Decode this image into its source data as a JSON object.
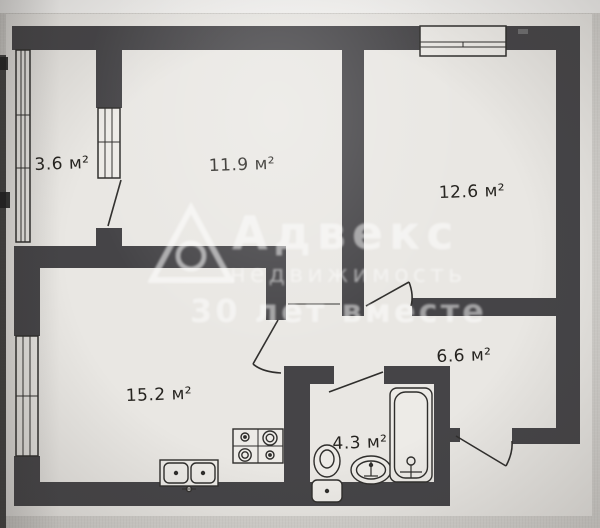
{
  "plan": {
    "type": "apartment-floor-plan",
    "rooms": [
      {
        "name": "balcony",
        "label": "3.6 м²"
      },
      {
        "name": "room-11-9",
        "label": "11.9 м²"
      },
      {
        "name": "room-12-6",
        "label": "12.6 м²"
      },
      {
        "name": "kitchen-living",
        "label": "15.2 м²"
      },
      {
        "name": "hallway",
        "label": "6.6 м²"
      },
      {
        "name": "bathroom",
        "label": "4.3 м²"
      }
    ],
    "fixtures": [
      "stove-4-burner",
      "double-kitchen-sink",
      "toilet",
      "washbasin",
      "bathtub"
    ],
    "watermark": {
      "line1": "Адвекс",
      "line2": "недвижимость",
      "line3": "30 лет вместе"
    }
  },
  "colors": {
    "wall": "#454447",
    "paper": "#e9e7e3",
    "bg": "#d4d2ce",
    "line": "#2f2e2c",
    "fixture": "#edebe7"
  }
}
